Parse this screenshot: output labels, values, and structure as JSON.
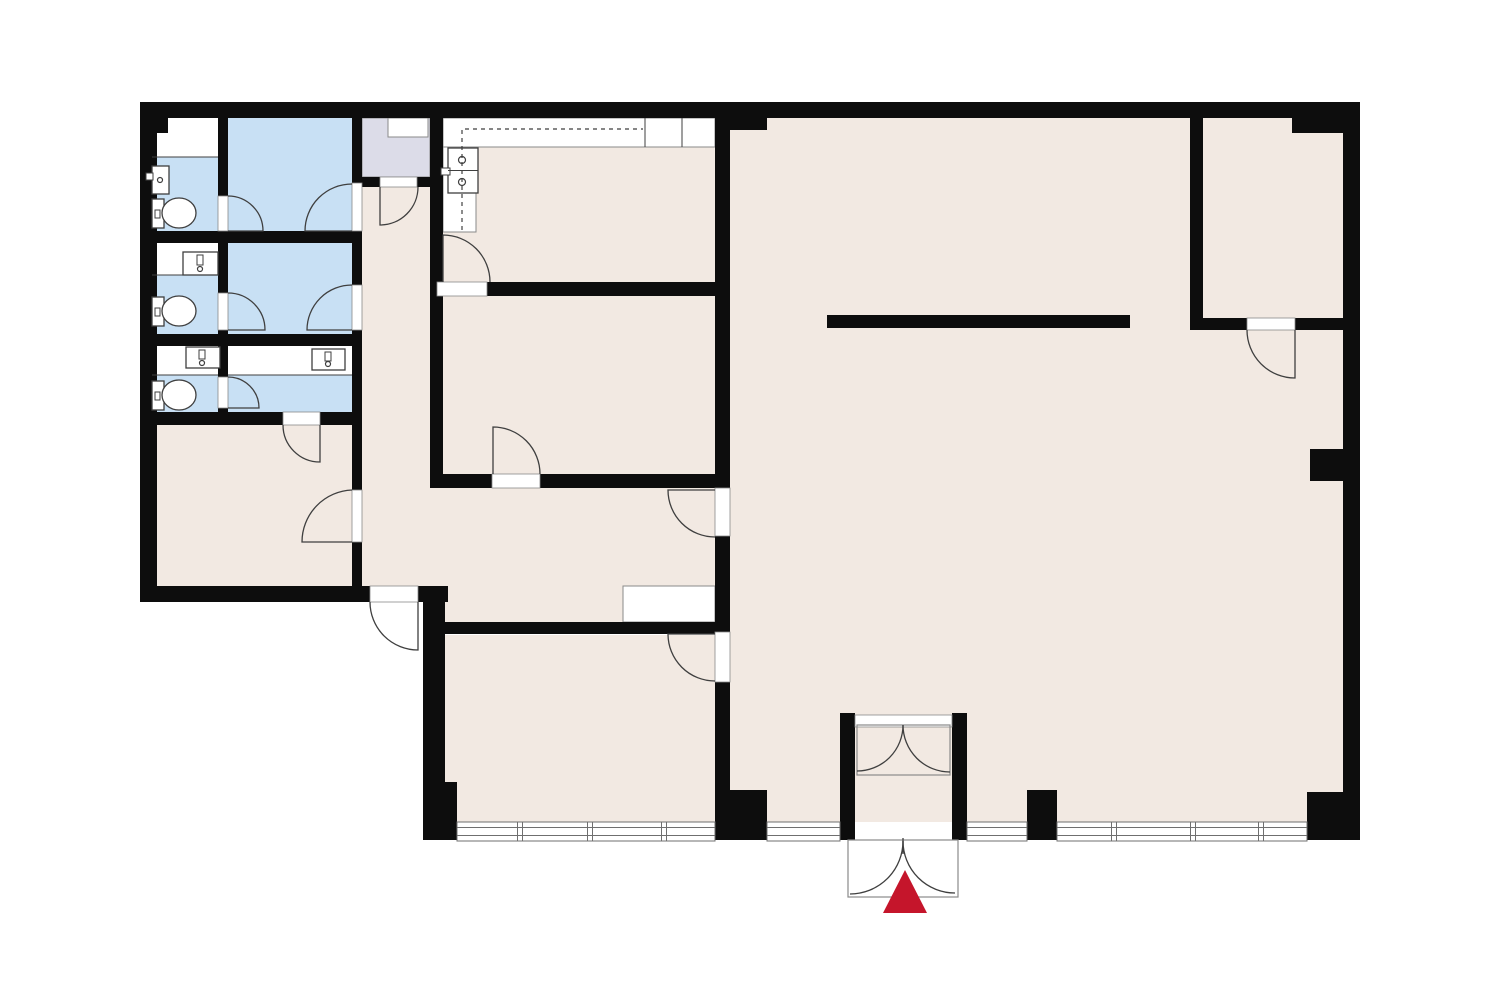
{
  "meta": {
    "description": "office floor plan with bathrooms, kitchen, hall and open space, entrance marked with red arrow"
  },
  "canvas": {
    "width": 1500,
    "height": 1000
  },
  "colors": {
    "background": "#ffffff",
    "floor": "#f2e9e2",
    "wet": "#c8e0f4",
    "closet": "#dcdce8",
    "wall": "#0d0d0d",
    "line": "#3f3f3f",
    "thin": "#8a8a8a",
    "window": "#6f6f6f",
    "accent_red": "#c5152b",
    "counter": "#ffffff"
  },
  "floors": [
    {
      "name": "corridor",
      "rect": [
        362,
        187,
        68,
        399
      ]
    },
    {
      "name": "kitchen",
      "rect": [
        443,
        118,
        272,
        164
      ]
    },
    {
      "name": "middle-room",
      "rect": [
        443,
        296,
        272,
        178
      ]
    },
    {
      "name": "hall",
      "rect": [
        430,
        488,
        285,
        134
      ]
    },
    {
      "name": "lower-left-room",
      "rect": [
        152,
        425,
        200,
        161
      ]
    },
    {
      "name": "bottom-middle-room",
      "rect": [
        445,
        635,
        270,
        187
      ]
    },
    {
      "name": "big-room",
      "rect": [
        730,
        118,
        613,
        704
      ]
    }
  ],
  "wet_rooms": [
    {
      "name": "bathroom-1",
      "rect": [
        152,
        157,
        66,
        74
      ]
    },
    {
      "name": "bathroom-2",
      "rect": [
        152,
        275,
        66,
        59
      ]
    },
    {
      "name": "bathroom-3",
      "rect": [
        152,
        375,
        66,
        37
      ]
    },
    {
      "name": "washroom-a",
      "rect": [
        228,
        118,
        124,
        113
      ]
    },
    {
      "name": "washroom-b",
      "rect": [
        228,
        243,
        124,
        91
      ]
    },
    {
      "name": "washroom-c",
      "rect": [
        228,
        375,
        124,
        37
      ]
    }
  ],
  "white_areas": [
    {
      "name": "bathroom-1-top",
      "rect": [
        152,
        118,
        66,
        39
      ]
    },
    {
      "name": "bathroom-2-top",
      "rect": [
        152,
        243,
        66,
        32
      ]
    },
    {
      "name": "bathroom-3-top",
      "rect": [
        152,
        346,
        66,
        29
      ]
    },
    {
      "name": "washroom-c-top",
      "rect": [
        228,
        346,
        124,
        29
      ]
    }
  ],
  "closet": {
    "rect": [
      362,
      118,
      68,
      59
    ],
    "inner_rect": [
      388,
      118,
      40,
      19
    ]
  },
  "counters": [
    {
      "name": "kitchen-counter-top",
      "rect": [
        443,
        118,
        272,
        29
      ]
    },
    {
      "name": "kitchen-counter-left",
      "rect": [
        443,
        147,
        33,
        85
      ]
    },
    {
      "name": "hall-counter",
      "rect": [
        623,
        586,
        92,
        36
      ]
    }
  ],
  "walls": [
    {
      "name": "top-wall",
      "rect": [
        140,
        102,
        1220,
        16
      ]
    },
    {
      "name": "left-wall",
      "rect": [
        140,
        102,
        17,
        500
      ]
    },
    {
      "name": "top-left-pier",
      "rect": [
        140,
        102,
        28,
        31
      ]
    },
    {
      "name": "bottom-left-wall-a",
      "rect": [
        140,
        586,
        230,
        16
      ]
    },
    {
      "name": "bottom-left-wall-b",
      "rect": [
        418,
        586,
        30,
        16
      ]
    },
    {
      "name": "bottom-room-left-wall",
      "rect": [
        423,
        586,
        22,
        254
      ]
    },
    {
      "name": "bottom-room-left-pier",
      "rect": [
        430,
        782,
        27,
        58
      ]
    },
    {
      "name": "bath-block-right-wall",
      "rect": [
        352,
        102,
        10,
        484
      ]
    },
    {
      "name": "bath-column-divider",
      "rect": [
        218,
        118,
        10,
        307
      ]
    },
    {
      "name": "bath-row-wall-1",
      "rect": [
        140,
        231,
        222,
        12
      ]
    },
    {
      "name": "bath-row-wall-2",
      "rect": [
        140,
        334,
        222,
        12
      ]
    },
    {
      "name": "bath-block-bottom-wall",
      "rect": [
        140,
        412,
        222,
        13
      ]
    },
    {
      "name": "closet-bottom-wall",
      "rect": [
        362,
        177,
        68,
        10
      ]
    },
    {
      "name": "kitchen-left-wall",
      "rect": [
        430,
        102,
        13,
        194
      ]
    },
    {
      "name": "kitchen-bottom-wall",
      "rect": [
        430,
        282,
        300,
        14
      ]
    },
    {
      "name": "middle-room-left-wall",
      "rect": [
        430,
        282,
        13,
        205
      ]
    },
    {
      "name": "middle-room-bottom-wall",
      "rect": [
        430,
        474,
        300,
        14
      ]
    },
    {
      "name": "hall-bottom-wall",
      "rect": [
        423,
        622,
        307,
        12
      ]
    },
    {
      "name": "main-vertical-wall",
      "rect": [
        715,
        102,
        15,
        738
      ]
    },
    {
      "name": "top-pier",
      "rect": [
        715,
        102,
        52,
        28
      ]
    },
    {
      "name": "main-wall-bottom-pier",
      "rect": [
        715,
        790,
        52,
        50
      ]
    },
    {
      "name": "upper-right-room-left-wall",
      "rect": [
        1190,
        118,
        13,
        212
      ]
    },
    {
      "name": "upper-right-room-bottom-wall",
      "rect": [
        1190,
        318,
        153,
        12
      ]
    },
    {
      "name": "upper-right-stub",
      "rect": [
        1292,
        118,
        51,
        15
      ]
    },
    {
      "name": "right-wall",
      "rect": [
        1343,
        102,
        17,
        738
      ]
    },
    {
      "name": "right-notch-pier",
      "rect": [
        1310,
        449,
        33,
        32
      ]
    },
    {
      "name": "bottom-right-block",
      "rect": [
        1307,
        792,
        53,
        48
      ]
    },
    {
      "name": "window-pier",
      "rect": [
        1027,
        790,
        30,
        50
      ]
    },
    {
      "name": "vestibule-left-post",
      "rect": [
        840,
        713,
        15,
        127
      ]
    },
    {
      "name": "vestibule-right-post",
      "rect": [
        952,
        713,
        15,
        127
      ]
    },
    {
      "name": "freestanding-wall",
      "rect": [
        827,
        315,
        303,
        13
      ]
    }
  ],
  "door_frames": [
    {
      "name": "washroom-a-left-gap",
      "rect": [
        218,
        196,
        10,
        35
      ]
    },
    {
      "name": "washroom-b-left-gap",
      "rect": [
        218,
        293,
        10,
        37
      ]
    },
    {
      "name": "washroom-c-left-gap",
      "rect": [
        218,
        377,
        10,
        31
      ]
    },
    {
      "name": "washroom-a-right-gap",
      "rect": [
        352,
        183,
        10,
        48
      ]
    },
    {
      "name": "washroom-b-right-gap",
      "rect": [
        352,
        285,
        10,
        45
      ]
    },
    {
      "name": "lower-left-room-gap",
      "rect": [
        352,
        490,
        10,
        52
      ]
    },
    {
      "name": "washroom-c-bottom-gap",
      "rect": [
        283,
        412,
        37,
        13
      ]
    },
    {
      "name": "corridor-top-gap",
      "rect": [
        380,
        177,
        37,
        10
      ]
    },
    {
      "name": "corridor-exit-gap",
      "rect": [
        370,
        586,
        48,
        16
      ]
    },
    {
      "name": "kitchen-door-gap",
      "rect": [
        437,
        282,
        50,
        14
      ]
    },
    {
      "name": "middle-room-door-gap",
      "rect": [
        492,
        474,
        48,
        14
      ]
    },
    {
      "name": "hall-door-gap",
      "rect": [
        715,
        488,
        15,
        48
      ]
    },
    {
      "name": "bottom-room-door-gap",
      "rect": [
        715,
        632,
        15,
        50
      ]
    },
    {
      "name": "upper-right-door-gap",
      "rect": [
        1247,
        318,
        48,
        12
      ]
    },
    {
      "name": "vestibule-inner-frame",
      "rect": [
        855,
        715,
        97,
        12
      ]
    }
  ],
  "doors": [
    {
      "name": "corridor-top-door",
      "path": "M380,187 L380,225 A38,38 0 0 0 418,187"
    },
    {
      "name": "kitchen-door",
      "path": "M443,282 L443,235 A47,47 0 0 1 490,282"
    },
    {
      "name": "middle-room-door",
      "path": "M493,474 L493,427 A47,47 0 0 1 540,474"
    },
    {
      "name": "hall-door",
      "path": "M715,490 L668,490 A47,47 0 0 0 715,537"
    },
    {
      "name": "bottom-room-door",
      "path": "M715,634 L668,634 A47,47 0 0 0 715,681"
    },
    {
      "name": "lower-left-room-door",
      "path": "M352,490 A52,52 0 0 0 302,542 L352,542"
    },
    {
      "name": "washroom-a-left-door",
      "path": "M228,196 A35,35 0 0 1 263,231 L228,231"
    },
    {
      "name": "washroom-a-right-door",
      "path": "M352,184 A47,47 0 0 0 305,231 L352,231"
    },
    {
      "name": "washroom-b-left-door",
      "path": "M228,293 A37,37 0 0 1 265,330 L228,330"
    },
    {
      "name": "washroom-b-right-door",
      "path": "M352,285 A45,45 0 0 0 307,330 L352,330"
    },
    {
      "name": "washroom-c-left-door",
      "path": "M228,377 A31,31 0 0 1 259,408 L228,408"
    },
    {
      "name": "washroom-c-bottom-door",
      "path": "M283,425 A37,37 0 0 0 320,462 L320,425"
    },
    {
      "name": "corridor-exit-door",
      "path": "M370,602 A48,48 0 0 0 418,650 L418,602"
    },
    {
      "name": "upper-right-room-door",
      "path": "M1247,330 A48,48 0 0 0 1295,378 L1295,330"
    },
    {
      "name": "vestibule-inner-left",
      "path": "M903,725 A46,46 0 0 1 857,771"
    },
    {
      "name": "vestibule-inner-right",
      "path": "M903,725 A47,47 0 0 0 950,772"
    },
    {
      "name": "entry-outer-left",
      "path": "M903,841 A53,53 0 0 1 850,894"
    },
    {
      "name": "entry-outer-right",
      "path": "M903,841 A52,52 0 0 0 955,893"
    },
    {
      "name": "entry-outer-center",
      "path": "M903,838 L903,854"
    }
  ],
  "door_boxes": [
    {
      "name": "vestibule-inner-door-box",
      "rect": [
        857,
        725,
        93,
        50
      ],
      "fill": "none"
    },
    {
      "name": "entry-outer-door-box",
      "rect": [
        848,
        840,
        110,
        57
      ],
      "fill": "#ffffff"
    }
  ],
  "windows": {
    "y": 822,
    "h": 19,
    "segments": [
      {
        "x1": 457,
        "x2": 715,
        "mullions": [
          520,
          590,
          664
        ]
      },
      {
        "x1": 767,
        "x2": 840,
        "mullions": []
      },
      {
        "x1": 967,
        "x2": 1027,
        "mullions": []
      },
      {
        "x1": 1057,
        "x2": 1307,
        "mullions": [
          1114,
          1193,
          1261
        ]
      }
    ]
  },
  "fixtures": {
    "toilets": [
      {
        "name": "toilet-1",
        "tank": [
          152,
          199,
          12,
          29
        ],
        "bowl": [
          179,
          213,
          17,
          15
        ],
        "dot": [
          155,
          210,
          5,
          8
        ]
      },
      {
        "name": "toilet-2",
        "tank": [
          152,
          297,
          12,
          29
        ],
        "bowl": [
          179,
          311,
          17,
          15
        ],
        "dot": [
          155,
          308,
          5,
          8
        ]
      },
      {
        "name": "toilet-3",
        "tank": [
          152,
          381,
          12,
          29
        ],
        "bowl": [
          179,
          395,
          17,
          15
        ],
        "dot": [
          155,
          392,
          5,
          8
        ]
      }
    ],
    "sinks": [
      {
        "name": "sink-1",
        "rect": [
          152,
          166,
          17,
          28
        ],
        "faucet": [
          146,
          173,
          7,
          7
        ],
        "circles": [
          [
            160,
            180,
            2.5
          ]
        ]
      },
      {
        "name": "sink-2",
        "rect": [
          183,
          252,
          35,
          23
        ],
        "faucet": [
          197,
          255,
          6,
          10
        ],
        "circles": [
          [
            200,
            269,
            2.5
          ]
        ]
      },
      {
        "name": "sink-3",
        "rect": [
          186,
          347,
          34,
          21
        ],
        "faucet": [
          199,
          350,
          6,
          9
        ],
        "circles": [
          [
            202,
            363,
            2.5
          ]
        ]
      },
      {
        "name": "sink-4",
        "rect": [
          312,
          349,
          33,
          21
        ],
        "faucet": [
          325,
          352,
          6,
          9
        ],
        "circles": [
          [
            328,
            364,
            2.5
          ]
        ]
      },
      {
        "name": "kitchen-sink",
        "rect": [
          448,
          148,
          30,
          45
        ],
        "faucet": [
          441,
          168,
          9,
          7
        ],
        "circles": [
          [
            462,
            160,
            3.5
          ],
          [
            462,
            182,
            3.5
          ]
        ]
      }
    ]
  },
  "lines": [
    {
      "name": "bath-1-band-edge",
      "pts": [
        152,
        157,
        218,
        157
      ]
    },
    {
      "name": "bath-2-band-edge",
      "pts": [
        152,
        275,
        218,
        275
      ]
    },
    {
      "name": "bath-3-band-edge",
      "pts": [
        152,
        375,
        218,
        375
      ]
    },
    {
      "name": "washroom-c-band-edge",
      "pts": [
        228,
        375,
        352,
        375
      ]
    },
    {
      "name": "kitchen-sink-divider",
      "pts": [
        448,
        170.5,
        478,
        170.5
      ]
    },
    {
      "name": "counter-divider-1",
      "pts": [
        645,
        118,
        645,
        147
      ]
    },
    {
      "name": "counter-divider-2",
      "pts": [
        682,
        118,
        682,
        147
      ]
    }
  ],
  "cabinet_dashed_path": "M462,230 L462,129 L643,129",
  "entrance": {
    "triangle": "905,870 883,913 927,913"
  }
}
